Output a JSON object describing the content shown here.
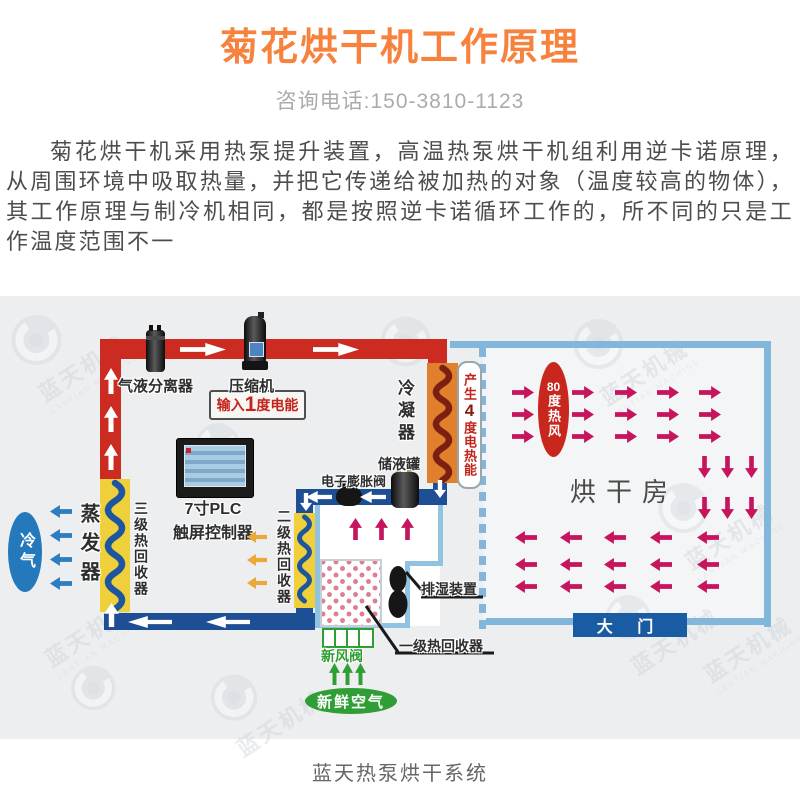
{
  "header": {
    "title": "菊花烘干机工作原理",
    "phone": "咨询电话:150-3810-1123"
  },
  "intro": {
    "paragraph": "菊花烘干机采用热泵提升装置，高温热泵烘干机组利用逆卡诺原理，从周围环境中吸取热量，并把它传递给被加热的对象（温度较高的物体），其工作原理与制冷机相同，都是按照逆卡诺循环工作的，所不同的只是工作温度范围不一"
  },
  "diagram": {
    "labels": {
      "separator": "气液分离器",
      "compressor": "压缩机",
      "input_prefix": "输入",
      "input_value": "1",
      "input_suffix": "度电能",
      "condenser": "冷凝器",
      "generate_prefix": "产生",
      "generate_value": "4",
      "generate_suffix": "度电热能",
      "tank": "储液罐",
      "expansion_valve": "电子膨胀阀",
      "plc_line1": "7寸PLC",
      "plc_line2": "触屏控制器",
      "cold_air": "冷气",
      "evaporator": "蒸发器",
      "recovery3": "三级热回收器",
      "recovery2": "二级热回收器",
      "recovery1": "一级热回收器",
      "dehumidifier": "排湿装置",
      "fresh_valve": "新风阀",
      "fresh_air": "新鲜空气",
      "hot_air_value": "80",
      "hot_air_suffix": "度热风",
      "room": "烘干房",
      "door": "大 门"
    },
    "watermark": {
      "cn": "蓝天机械",
      "en": "LANTIAN MACHINE"
    },
    "colors": {
      "accent_orange": "#F6823E",
      "pipe_hot": "#CC2B21",
      "pipe_cold": "#1E4F95",
      "room_border": "#82B7DB",
      "arrow_pink": "#C6155E",
      "arrow_blue": "#2C7CBE",
      "arrow_yellow": "#E9A93B",
      "arrow_green": "#2F9E34",
      "coil_yellow": "#EFCF3A",
      "condenser_orange": "#E0802C",
      "door_blue": "#1A5CA3",
      "hot_air_red": "#C8271D",
      "cold_air_blue": "#2478BC"
    }
  },
  "caption": "蓝天热泵烘干系统"
}
